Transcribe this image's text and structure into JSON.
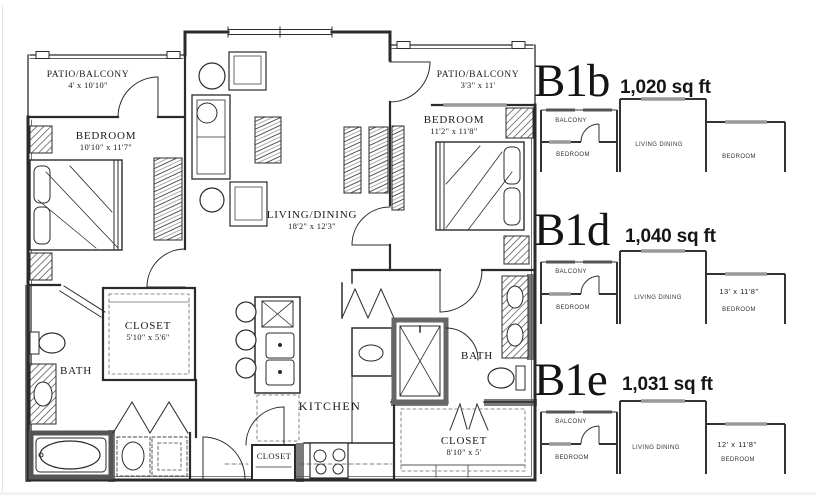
{
  "plan": {
    "rooms": {
      "patio_left": {
        "label": "PATIO/BALCONY",
        "dims": "4' x 10'10\""
      },
      "bedroom_left": {
        "label": "BEDROOM",
        "dims": "10'10\" x 11'7\""
      },
      "living_dining": {
        "label": "LIVING/DINING",
        "dims": "18'2\" x 12'3\""
      },
      "patio_right": {
        "label": "PATIO/BALCONY",
        "dims": "3'3\" x 11'"
      },
      "bedroom_right": {
        "label": "BEDROOM",
        "dims": "11'2\" x 11'8\""
      },
      "closet_left": {
        "label": "CLOSET",
        "dims": "5'10\" x 5'6\""
      },
      "bath_left": {
        "label": "BATH"
      },
      "kitchen": {
        "label": "KITCHEN"
      },
      "closet_hall": {
        "label": "CLOSET"
      },
      "bath_right": {
        "label": "BATH"
      },
      "closet_right": {
        "label": "CLOSET",
        "dims": "8'10\" x 5'"
      }
    }
  },
  "variants": [
    {
      "code": "B1b",
      "area": "1,020 sq ft",
      "balcony_label": "BALCONY",
      "bedroom_left_label": "BEDROOM",
      "living_label": "LIVING DINING",
      "bedroom_right_label": "BEDROOM",
      "bedroom_right_dims": ""
    },
    {
      "code": "B1d",
      "area": "1,040 sq ft",
      "balcony_label": "BALCONY",
      "bedroom_left_label": "BEDROOM",
      "living_label": "LIVING DINING",
      "bedroom_right_label": "BEDROOM",
      "bedroom_right_dims": "13' x 11'8\""
    },
    {
      "code": "B1e",
      "area": "1,031 sq ft",
      "balcony_label": "BALCONY",
      "bedroom_left_label": "BEDROOM",
      "living_label": "LIVING DINING",
      "bedroom_right_label": "BEDROOM",
      "bedroom_right_dims": "12' x 11'8\""
    }
  ]
}
